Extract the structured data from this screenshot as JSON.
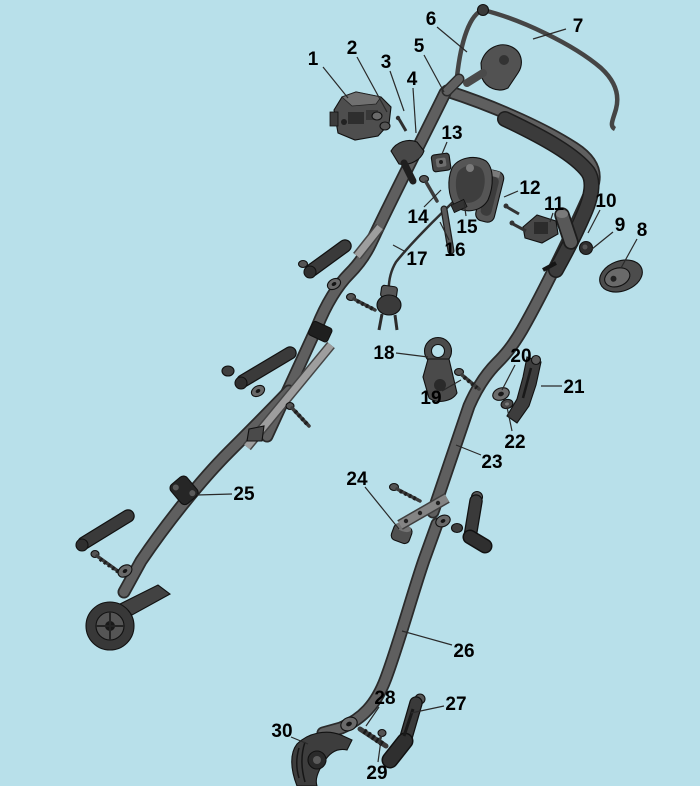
{
  "colors": {
    "background": "#b8e0ea",
    "tube": "#5f5f5f",
    "tube_outline": "#2b2b2b",
    "grip": "#3b3b3b",
    "part_dark": "#3a3a3a",
    "part_mid": "#555555",
    "part_light": "#9e9e9e",
    "label_text": "#000000",
    "leader_line": "#2a2a2a"
  },
  "labels": [
    {
      "num": "1",
      "tx": 313,
      "ty": 58,
      "x1": 323,
      "y1": 67,
      "x2": 348,
      "y2": 98
    },
    {
      "num": "2",
      "tx": 352,
      "ty": 47,
      "x1": 357,
      "y1": 57,
      "x2": 387,
      "y2": 112
    },
    {
      "num": "3",
      "tx": 386,
      "ty": 61,
      "x1": 390,
      "y1": 71,
      "x2": 404,
      "y2": 111
    },
    {
      "num": "4",
      "tx": 412,
      "ty": 78,
      "x1": 413,
      "y1": 88,
      "x2": 416,
      "y2": 133
    },
    {
      "num": "5",
      "tx": 419,
      "ty": 45,
      "x1": 424,
      "y1": 55,
      "x2": 444,
      "y2": 92
    },
    {
      "num": "6",
      "tx": 431,
      "ty": 18,
      "x1": 437,
      "y1": 27,
      "x2": 467,
      "y2": 52
    },
    {
      "num": "7",
      "tx": 578,
      "ty": 25,
      "x1": 566,
      "y1": 29,
      "x2": 533,
      "y2": 39
    },
    {
      "num": "8",
      "tx": 642,
      "ty": 229,
      "x1": 637,
      "y1": 239,
      "x2": 621,
      "y2": 268
    },
    {
      "num": "9",
      "tx": 620,
      "ty": 224,
      "x1": 613,
      "y1": 232,
      "x2": 592,
      "y2": 249
    },
    {
      "num": "10",
      "tx": 606,
      "ty": 200,
      "x1": 600,
      "y1": 210,
      "x2": 588,
      "y2": 233
    },
    {
      "num": "11",
      "tx": 554,
      "ty": 203,
      "x1": 553,
      "y1": 213,
      "x2": 550,
      "y2": 222
    },
    {
      "num": "12",
      "tx": 530,
      "ty": 187,
      "x1": 518,
      "y1": 191,
      "x2": 504,
      "y2": 197
    },
    {
      "num": "13",
      "tx": 452,
      "ty": 132,
      "x1": 447,
      "y1": 142,
      "x2": 442,
      "y2": 154
    },
    {
      "num": "14",
      "tx": 418,
      "ty": 216,
      "x1": 424,
      "y1": 207,
      "x2": 441,
      "y2": 190
    },
    {
      "num": "15",
      "tx": 467,
      "ty": 226,
      "x1": 466,
      "y1": 216,
      "x2": 464,
      "y2": 202
    },
    {
      "num": "16",
      "tx": 455,
      "ty": 249,
      "x1": 449,
      "y1": 240,
      "x2": 440,
      "y2": 222
    },
    {
      "num": "17",
      "tx": 417,
      "ty": 258,
      "x1": 406,
      "y1": 252,
      "x2": 393,
      "y2": 245
    },
    {
      "num": "18",
      "tx": 384,
      "ty": 352,
      "x1": 396,
      "y1": 353,
      "x2": 428,
      "y2": 357
    },
    {
      "num": "19",
      "tx": 431,
      "ty": 397,
      "x1": 442,
      "y1": 391,
      "x2": 461,
      "y2": 380
    },
    {
      "num": "20",
      "tx": 521,
      "ty": 355,
      "x1": 515,
      "y1": 365,
      "x2": 502,
      "y2": 390
    },
    {
      "num": "21",
      "tx": 574,
      "ty": 386,
      "x1": 562,
      "y1": 386,
      "x2": 541,
      "y2": 386
    },
    {
      "num": "22",
      "tx": 515,
      "ty": 441,
      "x1": 512,
      "y1": 431,
      "x2": 507,
      "y2": 407
    },
    {
      "num": "23",
      "tx": 492,
      "ty": 461,
      "x1": 481,
      "y1": 455,
      "x2": 456,
      "y2": 445
    },
    {
      "num": "24",
      "tx": 357,
      "ty": 478,
      "x1": 365,
      "y1": 487,
      "x2": 399,
      "y2": 529
    },
    {
      "num": "25",
      "tx": 244,
      "ty": 493,
      "x1": 232,
      "y1": 494,
      "x2": 197,
      "y2": 495
    },
    {
      "num": "26",
      "tx": 464,
      "ty": 650,
      "x1": 452,
      "y1": 645,
      "x2": 402,
      "y2": 631
    },
    {
      "num": "27",
      "tx": 456,
      "ty": 703,
      "x1": 444,
      "y1": 706,
      "x2": 411,
      "y2": 713
    },
    {
      "num": "28",
      "tx": 385,
      "ty": 697,
      "x1": 379,
      "y1": 707,
      "x2": 366,
      "y2": 726
    },
    {
      "num": "29",
      "tx": 377,
      "ty": 772,
      "x1": 378,
      "y1": 762,
      "x2": 381,
      "y2": 740
    },
    {
      "num": "30",
      "tx": 282,
      "ty": 730,
      "x1": 291,
      "y1": 737,
      "x2": 308,
      "y2": 744
    }
  ]
}
